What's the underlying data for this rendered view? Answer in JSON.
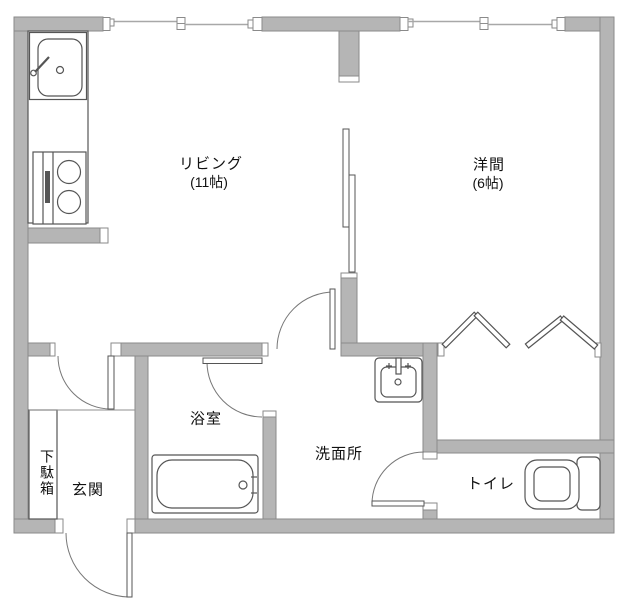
{
  "rooms": {
    "living": {
      "name": "リビング",
      "size": "(11帖)"
    },
    "western_room": {
      "name": "洋間",
      "size": "(6帖)"
    },
    "bathroom": {
      "name": "浴室"
    },
    "washroom": {
      "name": "洗面所"
    },
    "toilet": {
      "name": "トイレ"
    },
    "entrance": {
      "name": "玄関"
    },
    "shoe_cabinet": {
      "name": "下駄箱"
    }
  },
  "fixtures": [
    "kitchen-sink",
    "two-burner-stove",
    "bathtub",
    "washbasin",
    "toilet"
  ],
  "colors": {
    "wall_fill": "#b5b5b5",
    "wall_stroke": "#8a8a8a",
    "line": "#555555",
    "window_line": "#a8a8a8",
    "bg": "#ffffff",
    "text": "#111111",
    "arc": "#777777"
  }
}
